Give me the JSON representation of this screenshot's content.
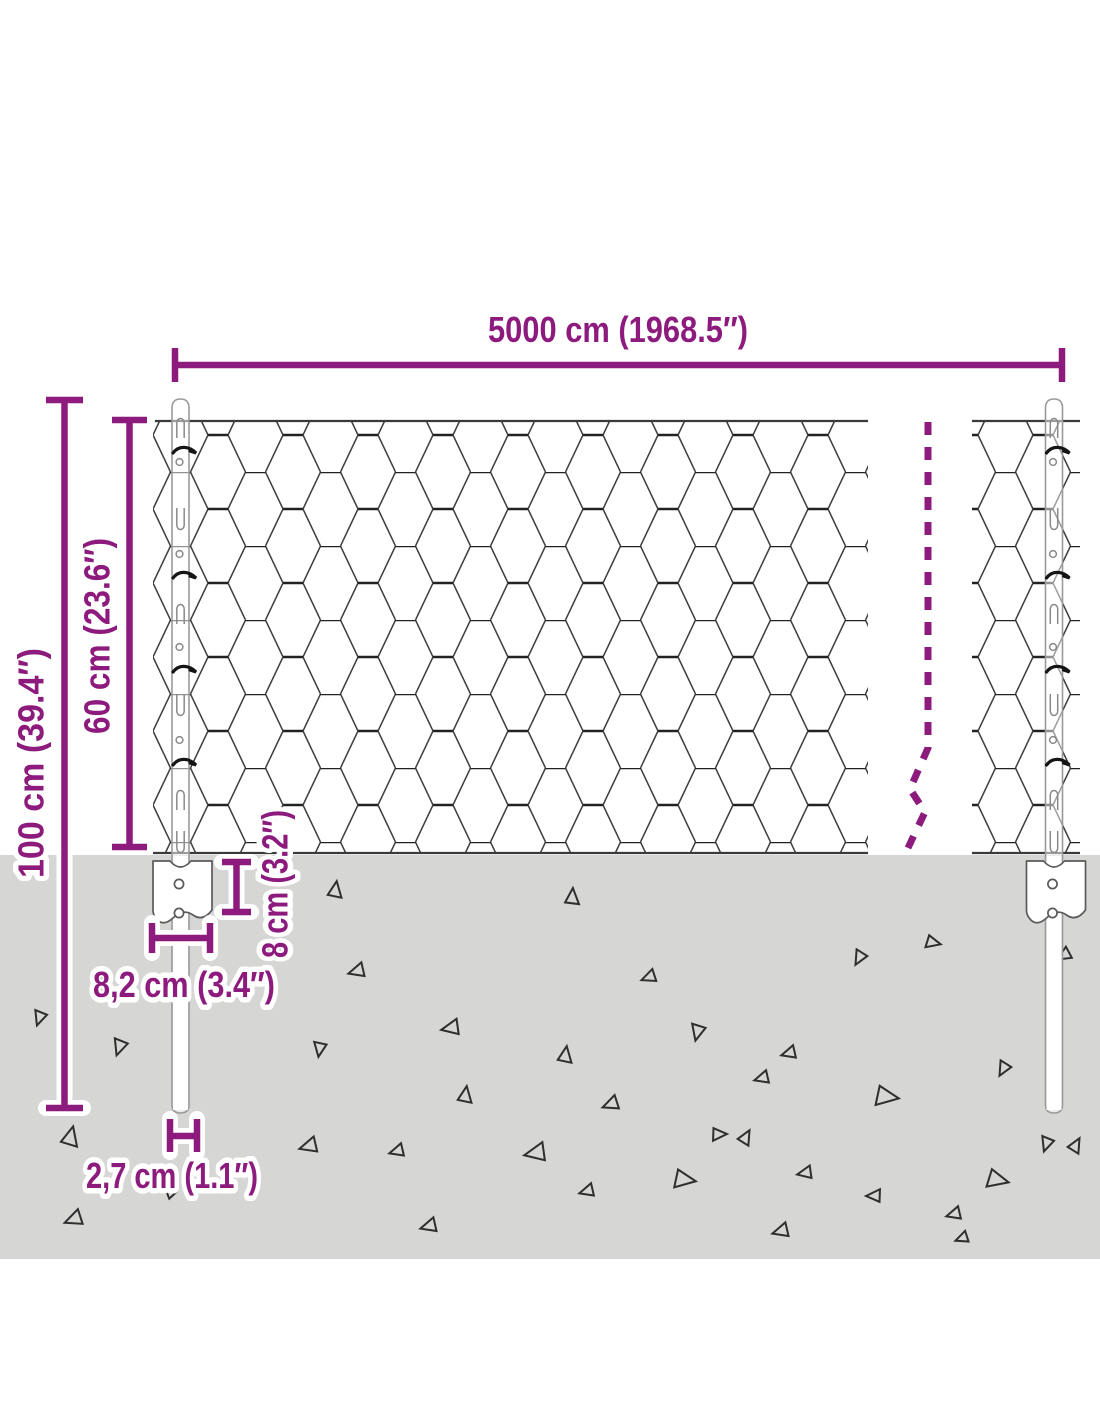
{
  "colors": {
    "accent": "#8d1b7e",
    "ground": "#d6d6d5",
    "mesh_line": "#3f3f3f",
    "post_outline": "#9a9a9a",
    "debris_outline": "#2e2e2e"
  },
  "dimensions": {
    "total_length": {
      "label": "5000 cm (1968.5″)",
      "cm": 5000,
      "inches": 1968.5
    },
    "post_height": {
      "label": "100 cm (39.4″)",
      "cm": 100,
      "inches": 39.4
    },
    "fence_height": {
      "label": "60 cm (23.6″)",
      "cm": 60,
      "inches": 23.6
    },
    "anchor_depth": {
      "label": "8 cm (3.2″)",
      "cm": 8,
      "inches": 3.2
    },
    "anchor_width": {
      "label": "8,2 cm (3.4″)",
      "cm": 8.2,
      "inches": 3.4
    },
    "post_width": {
      "label": "2,7 cm (1.1″)",
      "cm": 2.7,
      "inches": 1.1
    }
  },
  "ground": {
    "debris_triangles": [
      [
        40,
        1017,
        9,
        200
      ],
      [
        70,
        1138,
        12,
        15
      ],
      [
        75,
        1219,
        11,
        250
      ],
      [
        335,
        891,
        10,
        10
      ],
      [
        572,
        898,
        10,
        5
      ],
      [
        358,
        971,
        10,
        255
      ],
      [
        650,
        977,
        9,
        250
      ],
      [
        452,
        1028,
        11,
        260
      ],
      [
        320,
        1048,
        9,
        190
      ],
      [
        698,
        1031,
        10,
        195
      ],
      [
        120,
        1046,
        10,
        200
      ],
      [
        565,
        1056,
        10,
        10
      ],
      [
        790,
        1053,
        9,
        255
      ],
      [
        465,
        1096,
        10,
        10
      ],
      [
        612,
        1104,
        10,
        250
      ],
      [
        310,
        1146,
        11,
        255
      ],
      [
        398,
        1151,
        9,
        255
      ],
      [
        537,
        1153,
        13,
        260
      ],
      [
        718,
        1134,
        9,
        90
      ],
      [
        763,
        1078,
        9,
        255
      ],
      [
        885,
        1096,
        14,
        100
      ],
      [
        1004,
        1068,
        9,
        210
      ],
      [
        1047,
        1143,
        9,
        200
      ],
      [
        745,
        1138,
        9,
        30
      ],
      [
        806,
        1173,
        9,
        260
      ],
      [
        588,
        1191,
        9,
        255
      ],
      [
        683,
        1179,
        13,
        100
      ],
      [
        875,
        1196,
        9,
        270
      ],
      [
        955,
        1214,
        9,
        255
      ],
      [
        996,
        1179,
        13,
        105
      ],
      [
        782,
        1231,
        10,
        255
      ],
      [
        860,
        957,
        9,
        210
      ],
      [
        932,
        942,
        9,
        105
      ],
      [
        1075,
        1146,
        9,
        30
      ],
      [
        170,
        1193,
        7,
        315
      ],
      [
        430,
        1226,
        10,
        255
      ],
      [
        963,
        1238,
        8,
        250
      ],
      [
        1065,
        955,
        9,
        240
      ]
    ]
  }
}
